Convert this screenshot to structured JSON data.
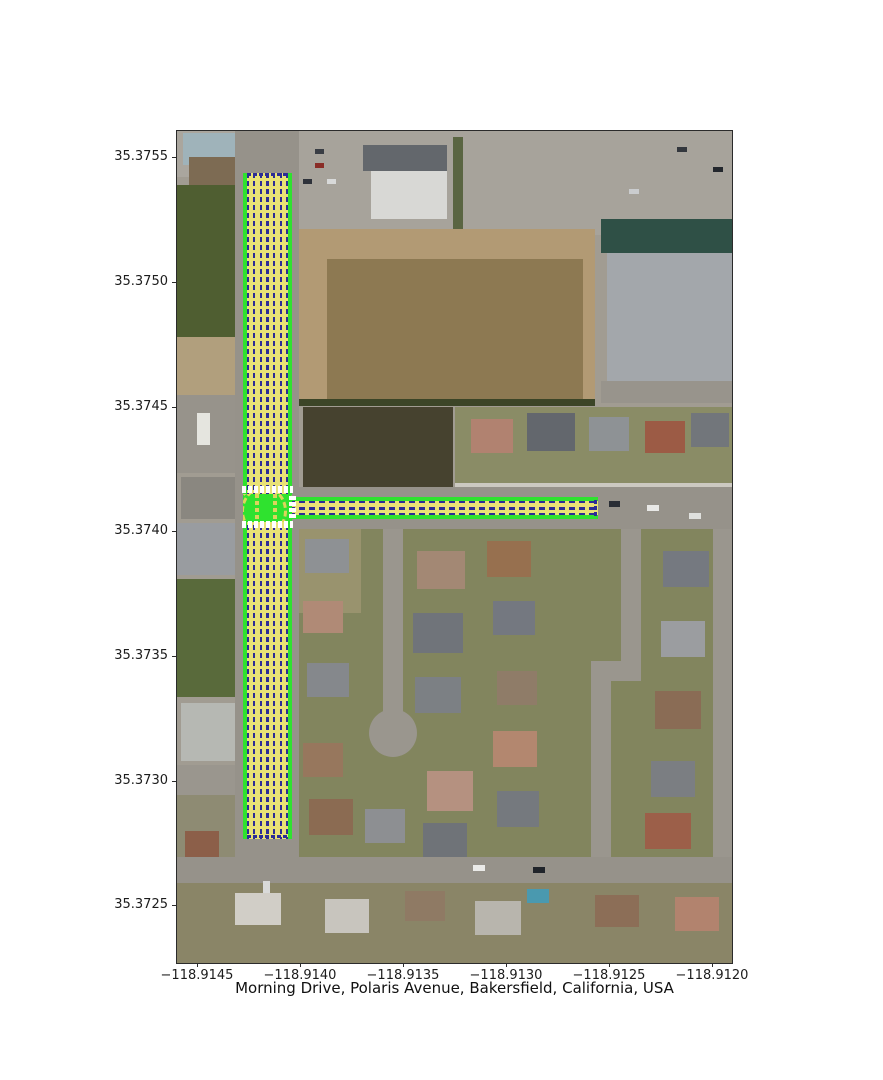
{
  "figure": {
    "title": "Morning Drive, Polaris Avenue, Bakersfield, California, USA",
    "x_ticks": [
      {
        "label": "−118.9145",
        "pos": 21
      },
      {
        "label": "−118.9140",
        "pos": 124
      },
      {
        "label": "−118.9135",
        "pos": 227
      },
      {
        "label": "−118.9130",
        "pos": 330
      },
      {
        "label": "−118.9125",
        "pos": 433
      },
      {
        "label": "−118.9120",
        "pos": 536
      }
    ],
    "y_ticks": [
      {
        "label": "35.3755",
        "pos": 27
      },
      {
        "label": "35.3750",
        "pos": 152
      },
      {
        "label": "35.3745",
        "pos": 277
      },
      {
        "label": "35.3740",
        "pos": 401
      },
      {
        "label": "35.3735",
        "pos": 526
      },
      {
        "label": "35.3730",
        "pos": 651
      },
      {
        "label": "35.3725",
        "pos": 775
      }
    ]
  },
  "overlay": {
    "colors": {
      "edge": "#2fe22f",
      "lane": "#e9e276",
      "line": "#2c2c96",
      "cross": "#ffffff",
      "path": "#ddd45c"
    },
    "roads": [
      {
        "name": "morning-drive-overlay",
        "x": 66,
        "y": 42,
        "w": 49,
        "h": 666,
        "dir": "v",
        "lanes": 6
      },
      {
        "name": "polaris-avenue-overlay",
        "x": 112,
        "y": 366,
        "w": 309,
        "h": 22,
        "dir": "h",
        "lanes": 2
      }
    ],
    "junction": {
      "name": "junction-markings",
      "x": 66,
      "y": 363,
      "w": 49,
      "h": 28
    },
    "bars": [
      {
        "name": "crosswalk-north",
        "x": 65,
        "y": 355,
        "w": 51,
        "h": 7,
        "dir": "h"
      },
      {
        "name": "crosswalk-south",
        "x": 65,
        "y": 390,
        "w": 51,
        "h": 7,
        "dir": "h"
      },
      {
        "name": "crosswalk-west",
        "x": 112,
        "y": 365,
        "w": 7,
        "h": 24,
        "dir": "v"
      },
      {
        "name": "stopline-top",
        "x": 70,
        "y": 42,
        "w": 41,
        "h": 3,
        "dir": "h",
        "color": "line"
      },
      {
        "name": "stopline-bottom",
        "x": 70,
        "y": 704,
        "w": 41,
        "h": 3,
        "dir": "h",
        "color": "line"
      },
      {
        "name": "stopline-east",
        "x": 417,
        "y": 369,
        "w": 3,
        "h": 16,
        "dir": "v",
        "color": "line"
      }
    ]
  },
  "basemap": {
    "base_color": "#a19c92",
    "blocks": [
      {
        "n": "top-strip",
        "x": 0,
        "y": 0,
        "w": 555,
        "h": 46,
        "c": "#aaa69e"
      },
      {
        "n": "building-blue-roof",
        "x": 6,
        "y": 2,
        "w": 56,
        "h": 32,
        "c": "#9fb3ba"
      },
      {
        "n": "building-brown",
        "x": 12,
        "y": 26,
        "w": 50,
        "h": 40,
        "c": "#7d6b53"
      },
      {
        "n": "field-dark-green",
        "x": 0,
        "y": 54,
        "w": 64,
        "h": 152,
        "c": "#4f5e31"
      },
      {
        "n": "dirt-lot-left",
        "x": 0,
        "y": 206,
        "w": 64,
        "h": 58,
        "c": "#b19f7d"
      },
      {
        "n": "pavement-left",
        "x": 0,
        "y": 264,
        "w": 64,
        "h": 78,
        "c": "#97938b"
      },
      {
        "n": "trailer",
        "x": 20,
        "y": 282,
        "w": 13,
        "h": 32,
        "c": "#e5e5df"
      },
      {
        "n": "house",
        "x": 4,
        "y": 346,
        "w": 54,
        "h": 42,
        "c": "#8a8780"
      },
      {
        "n": "house",
        "x": 0,
        "y": 392,
        "w": 60,
        "h": 52,
        "c": "#999ca0"
      },
      {
        "n": "field-green",
        "x": 0,
        "y": 448,
        "w": 64,
        "h": 118,
        "c": "#596a3b"
      },
      {
        "n": "house",
        "x": 4,
        "y": 572,
        "w": 56,
        "h": 58,
        "c": "#b6b8b3"
      },
      {
        "n": "street",
        "x": 0,
        "y": 634,
        "w": 64,
        "h": 30,
        "c": "#9a968e"
      },
      {
        "n": "lots-bottom-left",
        "x": 0,
        "y": 664,
        "w": 64,
        "h": 168,
        "c": "#8e8b73"
      },
      {
        "n": "house",
        "x": 8,
        "y": 700,
        "w": 34,
        "h": 40,
        "c": "#8c5f49"
      },
      {
        "n": "asphalt-morning-drive",
        "x": 58,
        "y": 0,
        "w": 64,
        "h": 832,
        "c": "#96928a"
      },
      {
        "n": "parking-lot",
        "x": 122,
        "y": 0,
        "w": 433,
        "h": 104,
        "c": "#a7a39b"
      },
      {
        "n": "store-dark-roof",
        "x": 186,
        "y": 14,
        "w": 84,
        "h": 26,
        "c": "#63676c"
      },
      {
        "n": "store-white-roof",
        "x": 194,
        "y": 40,
        "w": 76,
        "h": 48,
        "c": "#d8d8d5"
      },
      {
        "n": "trees",
        "x": 276,
        "y": 6,
        "w": 10,
        "h": 94,
        "c": "#5a6542"
      },
      {
        "n": "teal-building",
        "x": 424,
        "y": 88,
        "w": 131,
        "h": 34,
        "c": "#2f5046"
      },
      {
        "n": "industrial-building",
        "x": 430,
        "y": 122,
        "w": 125,
        "h": 128,
        "c": "#a3a7ab"
      },
      {
        "n": "street",
        "x": 424,
        "y": 250,
        "w": 131,
        "h": 22,
        "c": "#98948c"
      },
      {
        "n": "dirt-field",
        "x": 122,
        "y": 98,
        "w": 296,
        "h": 176,
        "c": "#b29a74"
      },
      {
        "n": "plowed-field",
        "x": 150,
        "y": 128,
        "w": 256,
        "h": 142,
        "c": "#8d7952"
      },
      {
        "n": "tree-line",
        "x": 122,
        "y": 268,
        "w": 296,
        "h": 7,
        "c": "#3c4527"
      },
      {
        "n": "dark-field",
        "x": 126,
        "y": 276,
        "w": 150,
        "h": 82,
        "c": "#46422f"
      },
      {
        "n": "residential-north",
        "x": 278,
        "y": 276,
        "w": 277,
        "h": 82,
        "c": "#8a8c66"
      },
      {
        "n": "house",
        "x": 294,
        "y": 288,
        "w": 42,
        "h": 34,
        "c": "#b18270"
      },
      {
        "n": "house",
        "x": 350,
        "y": 282,
        "w": 48,
        "h": 38,
        "c": "#63676d"
      },
      {
        "n": "house",
        "x": 412,
        "y": 286,
        "w": 40,
        "h": 34,
        "c": "#8e9295"
      },
      {
        "n": "house",
        "x": 468,
        "y": 290,
        "w": 40,
        "h": 32,
        "c": "#9c5b45"
      },
      {
        "n": "house",
        "x": 514,
        "y": 282,
        "w": 38,
        "h": 34,
        "c": "#72767b"
      },
      {
        "n": "sidewalk",
        "x": 278,
        "y": 352,
        "w": 277,
        "h": 6,
        "c": "#ccc9c1"
      },
      {
        "n": "asphalt-polaris-avenue",
        "x": 112,
        "y": 356,
        "w": 443,
        "h": 42,
        "c": "#96928a"
      },
      {
        "n": "residential-south",
        "x": 122,
        "y": 398,
        "w": 433,
        "h": 328,
        "c": "#82855e"
      },
      {
        "n": "lot-tan",
        "x": 122,
        "y": 398,
        "w": 62,
        "h": 84,
        "c": "#99936e"
      },
      {
        "n": "street-court",
        "x": 206,
        "y": 398,
        "w": 20,
        "h": 192,
        "c": "#9a968e"
      },
      {
        "n": "cul-de-sac",
        "x": 192,
        "y": 578,
        "w": 48,
        "h": 48,
        "c": "#9a968e",
        "r": 24
      },
      {
        "n": "street-loop",
        "x": 444,
        "y": 398,
        "w": 20,
        "h": 150,
        "c": "#9a968e"
      },
      {
        "n": "street-loop",
        "x": 414,
        "y": 530,
        "w": 50,
        "h": 20,
        "c": "#9a968e"
      },
      {
        "n": "street-loop",
        "x": 414,
        "y": 548,
        "w": 20,
        "h": 178,
        "c": "#9a968e"
      },
      {
        "n": "street-right",
        "x": 536,
        "y": 398,
        "w": 19,
        "h": 328,
        "c": "#9a968e"
      },
      {
        "n": "house",
        "x": 128,
        "y": 408,
        "w": 44,
        "h": 34,
        "c": "#8e9194"
      },
      {
        "n": "house",
        "x": 126,
        "y": 470,
        "w": 40,
        "h": 32,
        "c": "#b08a76"
      },
      {
        "n": "house",
        "x": 130,
        "y": 532,
        "w": 42,
        "h": 34,
        "c": "#85888c"
      },
      {
        "n": "house",
        "x": 126,
        "y": 612,
        "w": 40,
        "h": 34,
        "c": "#97775d"
      },
      {
        "n": "house",
        "x": 132,
        "y": 668,
        "w": 44,
        "h": 36,
        "c": "#8b6b52"
      },
      {
        "n": "house",
        "x": 240,
        "y": 420,
        "w": 48,
        "h": 38,
        "c": "#a38874"
      },
      {
        "n": "house",
        "x": 236,
        "y": 482,
        "w": 50,
        "h": 40,
        "c": "#70747a"
      },
      {
        "n": "house",
        "x": 238,
        "y": 546,
        "w": 46,
        "h": 36,
        "c": "#7c8084"
      },
      {
        "n": "house",
        "x": 250,
        "y": 640,
        "w": 46,
        "h": 40,
        "c": "#b59180"
      },
      {
        "n": "house",
        "x": 188,
        "y": 678,
        "w": 40,
        "h": 34,
        "c": "#8d8f92"
      },
      {
        "n": "house",
        "x": 246,
        "y": 692,
        "w": 44,
        "h": 34,
        "c": "#6f7378"
      },
      {
        "n": "house",
        "x": 310,
        "y": 410,
        "w": 44,
        "h": 36,
        "c": "#97704f"
      },
      {
        "n": "house",
        "x": 316,
        "y": 470,
        "w": 42,
        "h": 34,
        "c": "#747880"
      },
      {
        "n": "house",
        "x": 320,
        "y": 540,
        "w": 40,
        "h": 34,
        "c": "#8f7c68"
      },
      {
        "n": "house",
        "x": 316,
        "y": 600,
        "w": 44,
        "h": 36,
        "c": "#b3876f"
      },
      {
        "n": "house",
        "x": 320,
        "y": 660,
        "w": 42,
        "h": 36,
        "c": "#75797e"
      },
      {
        "n": "house",
        "x": 486,
        "y": 420,
        "w": 46,
        "h": 36,
        "c": "#757980"
      },
      {
        "n": "house",
        "x": 484,
        "y": 490,
        "w": 44,
        "h": 36,
        "c": "#9b9da0"
      },
      {
        "n": "house",
        "x": 478,
        "y": 560,
        "w": 46,
        "h": 38,
        "c": "#8a6c55"
      },
      {
        "n": "house",
        "x": 474,
        "y": 630,
        "w": 44,
        "h": 36,
        "c": "#7b7e82"
      },
      {
        "n": "house",
        "x": 468,
        "y": 682,
        "w": 46,
        "h": 36,
        "c": "#9c5f49"
      },
      {
        "n": "road-bottom",
        "x": 0,
        "y": 726,
        "w": 555,
        "h": 26,
        "c": "#96928a"
      },
      {
        "n": "bottom-band",
        "x": 0,
        "y": 752,
        "w": 555,
        "h": 80,
        "c": "#8a8567"
      },
      {
        "n": "house",
        "x": 58,
        "y": 762,
        "w": 46,
        "h": 32,
        "c": "#d1cec7"
      },
      {
        "n": "house",
        "x": 148,
        "y": 768,
        "w": 44,
        "h": 34,
        "c": "#c8c5be"
      },
      {
        "n": "house",
        "x": 228,
        "y": 760,
        "w": 40,
        "h": 30,
        "c": "#8f7a64"
      },
      {
        "n": "house",
        "x": 298,
        "y": 770,
        "w": 46,
        "h": 34,
        "c": "#b8b5ad"
      },
      {
        "n": "pool-tarp",
        "x": 350,
        "y": 758,
        "w": 22,
        "h": 14,
        "c": "#4a99af"
      },
      {
        "n": "house",
        "x": 418,
        "y": 764,
        "w": 44,
        "h": 32,
        "c": "#8c6e57"
      },
      {
        "n": "house",
        "x": 498,
        "y": 766,
        "w": 44,
        "h": 34,
        "c": "#b2836e"
      },
      {
        "n": "car",
        "x": 138,
        "y": 18,
        "w": 9,
        "h": 5,
        "c": "#393d44"
      },
      {
        "n": "car",
        "x": 138,
        "y": 32,
        "w": 9,
        "h": 5,
        "c": "#8a2d27"
      },
      {
        "n": "car",
        "x": 126,
        "y": 48,
        "w": 9,
        "h": 5,
        "c": "#2e323a"
      },
      {
        "n": "car",
        "x": 150,
        "y": 48,
        "w": 9,
        "h": 5,
        "c": "#d8d9d9"
      },
      {
        "n": "car",
        "x": 452,
        "y": 58,
        "w": 10,
        "h": 5,
        "c": "#caccce"
      },
      {
        "n": "car",
        "x": 536,
        "y": 36,
        "w": 10,
        "h": 5,
        "c": "#23272d"
      },
      {
        "n": "car",
        "x": 500,
        "y": 16,
        "w": 10,
        "h": 5,
        "c": "#33373d"
      },
      {
        "n": "car",
        "x": 470,
        "y": 374,
        "w": 12,
        "h": 6,
        "c": "#e8e8e6"
      },
      {
        "n": "car",
        "x": 512,
        "y": 382,
        "w": 12,
        "h": 6,
        "c": "#dfe0dd"
      },
      {
        "n": "car",
        "x": 432,
        "y": 370,
        "w": 11,
        "h": 6,
        "c": "#2a2e35"
      },
      {
        "n": "car",
        "x": 296,
        "y": 734,
        "w": 12,
        "h": 6,
        "c": "#eaeae8"
      },
      {
        "n": "car",
        "x": 356,
        "y": 736,
        "w": 12,
        "h": 6,
        "c": "#20242a"
      },
      {
        "n": "car",
        "x": 86,
        "y": 750,
        "w": 7,
        "h": 12,
        "c": "#d9dad9"
      }
    ]
  }
}
